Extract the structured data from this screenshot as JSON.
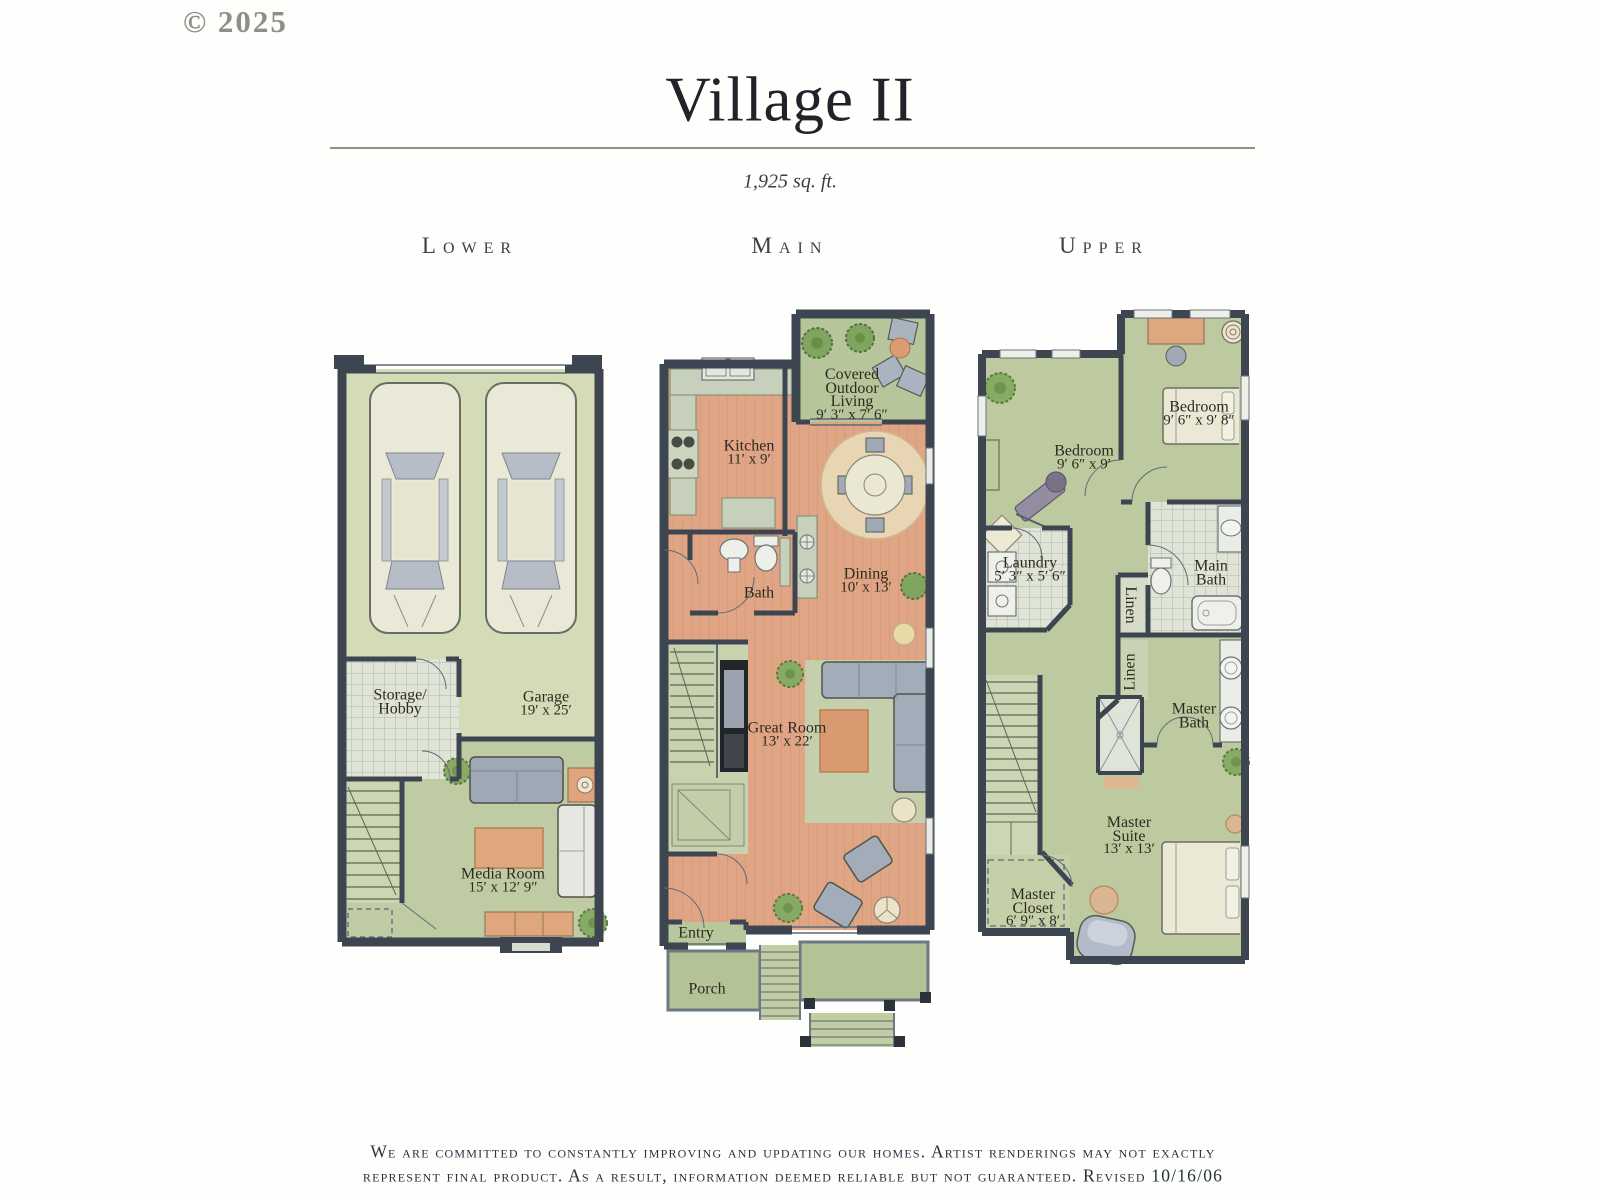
{
  "page": {
    "copyright": "© 2025",
    "title": "Village II",
    "square_footage": "1,925 sq. ft.",
    "footer_line1": "We are committed to constantly improving and updating our homes. Artist renderings may not exactly",
    "footer_line2": "represent final product. As a result, information deemed reliable but not guaranteed. Revised 10/16/06"
  },
  "colors": {
    "wall": "#3d4650",
    "wood_floor": "#e0a584",
    "green_floor": "#bdc99e",
    "garage_floor": "#d3dcb6",
    "rug_orange": "#d99a72",
    "sofa_gray": "#a3adb9"
  },
  "floors": {
    "lower": {
      "label": "Lower",
      "rooms": {
        "storage": {
          "line1": "Storage/",
          "line2": "Hobby"
        },
        "garage": {
          "line1": "Garage",
          "dims": "19′ x 25′"
        },
        "media_room": {
          "line1": "Media Room",
          "dims": "15′ x 12′ 9″"
        }
      }
    },
    "main": {
      "label": "Main",
      "rooms": {
        "covered_outdoor_living": {
          "line1": "Covered",
          "line2": "Outdoor",
          "line3": "Living",
          "dims": "9′ 3″ x 7′ 6″"
        },
        "kitchen": {
          "line1": "Kitchen",
          "dims": "11′ x 9′"
        },
        "dining": {
          "line1": "Dining",
          "dims": "10′ x 13′"
        },
        "bath": {
          "line1": "Bath"
        },
        "great_room": {
          "line1": "Great Room",
          "dims": "13′ x 22′"
        },
        "entry": {
          "line1": "Entry"
        },
        "porch": {
          "line1": "Porch"
        }
      }
    },
    "upper": {
      "label": "Upper",
      "rooms": {
        "bedroom_left": {
          "line1": "Bedroom",
          "dims": "9′ 6″ x 9′"
        },
        "bedroom_right": {
          "line1": "Bedroom",
          "dims": "9′ 6″ x 9′ 8″"
        },
        "laundry": {
          "line1": "Laundry",
          "dims": "5′ 3″ x 5′ 6″"
        },
        "main_bath": {
          "line1": "Main",
          "line2": "Bath"
        },
        "linen_upper": {
          "line1": "Linen"
        },
        "linen_lower": {
          "line1": "Linen"
        },
        "master_bath": {
          "line1": "Master",
          "line2": "Bath"
        },
        "master_suite": {
          "line1": "Master",
          "line2": "Suite",
          "dims": "13′ x 13′"
        },
        "master_closet": {
          "line1": "Master",
          "line2": "Closet",
          "dims": "6′ 9″ x 8′"
        }
      }
    }
  }
}
